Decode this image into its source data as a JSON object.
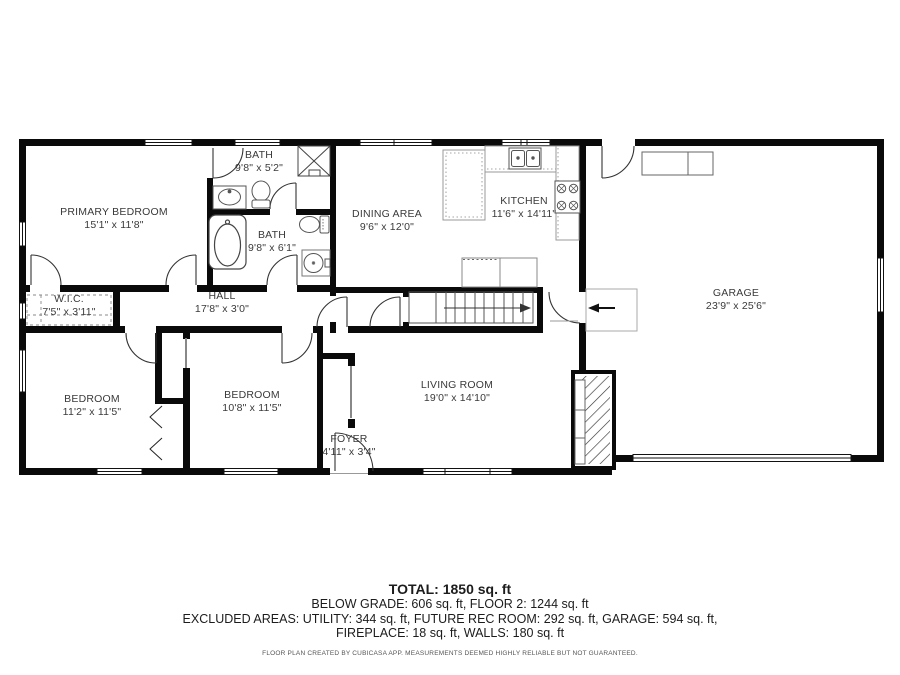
{
  "colors": {
    "wall": "#0a0a0a",
    "label": "#3a3a3a",
    "fixture": "#555555",
    "counter": "#999999"
  },
  "rooms": [
    {
      "id": "primary-bedroom",
      "name": "PRIMARY BEDROOM",
      "dims": "15'1\" x 11'8\""
    },
    {
      "id": "bath-1",
      "name": "BATH",
      "dims": "9'8\" x 5'2\""
    },
    {
      "id": "bath-2",
      "name": "BATH",
      "dims": "9'8\" x 6'1\""
    },
    {
      "id": "wic",
      "name": "W.I.C.",
      "dims": "7'5\" x 3'11\""
    },
    {
      "id": "hall",
      "name": "HALL",
      "dims": "17'8\" x 3'0\""
    },
    {
      "id": "dining-area",
      "name": "DINING AREA",
      "dims": "9'6\" x 12'0\""
    },
    {
      "id": "kitchen",
      "name": "KITCHEN",
      "dims": "11'6\" x 14'11\""
    },
    {
      "id": "garage",
      "name": "GARAGE",
      "dims": "23'9\" x 25'6\""
    },
    {
      "id": "bedroom-left",
      "name": "BEDROOM",
      "dims": "11'2\" x 11'5\""
    },
    {
      "id": "bedroom-right",
      "name": "BEDROOM",
      "dims": "10'8\" x 11'5\""
    },
    {
      "id": "living-room",
      "name": "LIVING ROOM",
      "dims": "19'0\" x 14'10\""
    },
    {
      "id": "foyer",
      "name": "FOYER",
      "dims": "4'11\" x 3'4\""
    }
  ],
  "summary": {
    "total": "TOTAL: 1850 sq. ft",
    "line1": "BELOW GRADE: 606 sq. ft, FLOOR 2: 1244 sq. ft",
    "line2": "EXCLUDED AREAS: UTILITY: 344 sq. ft, FUTURE REC ROOM: 292 sq. ft, GARAGE: 594 sq. ft,",
    "line3": "FIREPLACE: 18 sq. ft, WALLS: 180 sq. ft",
    "disclaimer": "FLOOR PLAN CREATED BY CUBICASA APP. MEASUREMENTS DEEMED HIGHLY RELIABLE BUT NOT GUARANTEED."
  },
  "symbols": {
    "stairs_arrow": "right-arrow",
    "entrance_arrow": "left-arrow",
    "fireplace_fill": "diagonal-hatch"
  }
}
